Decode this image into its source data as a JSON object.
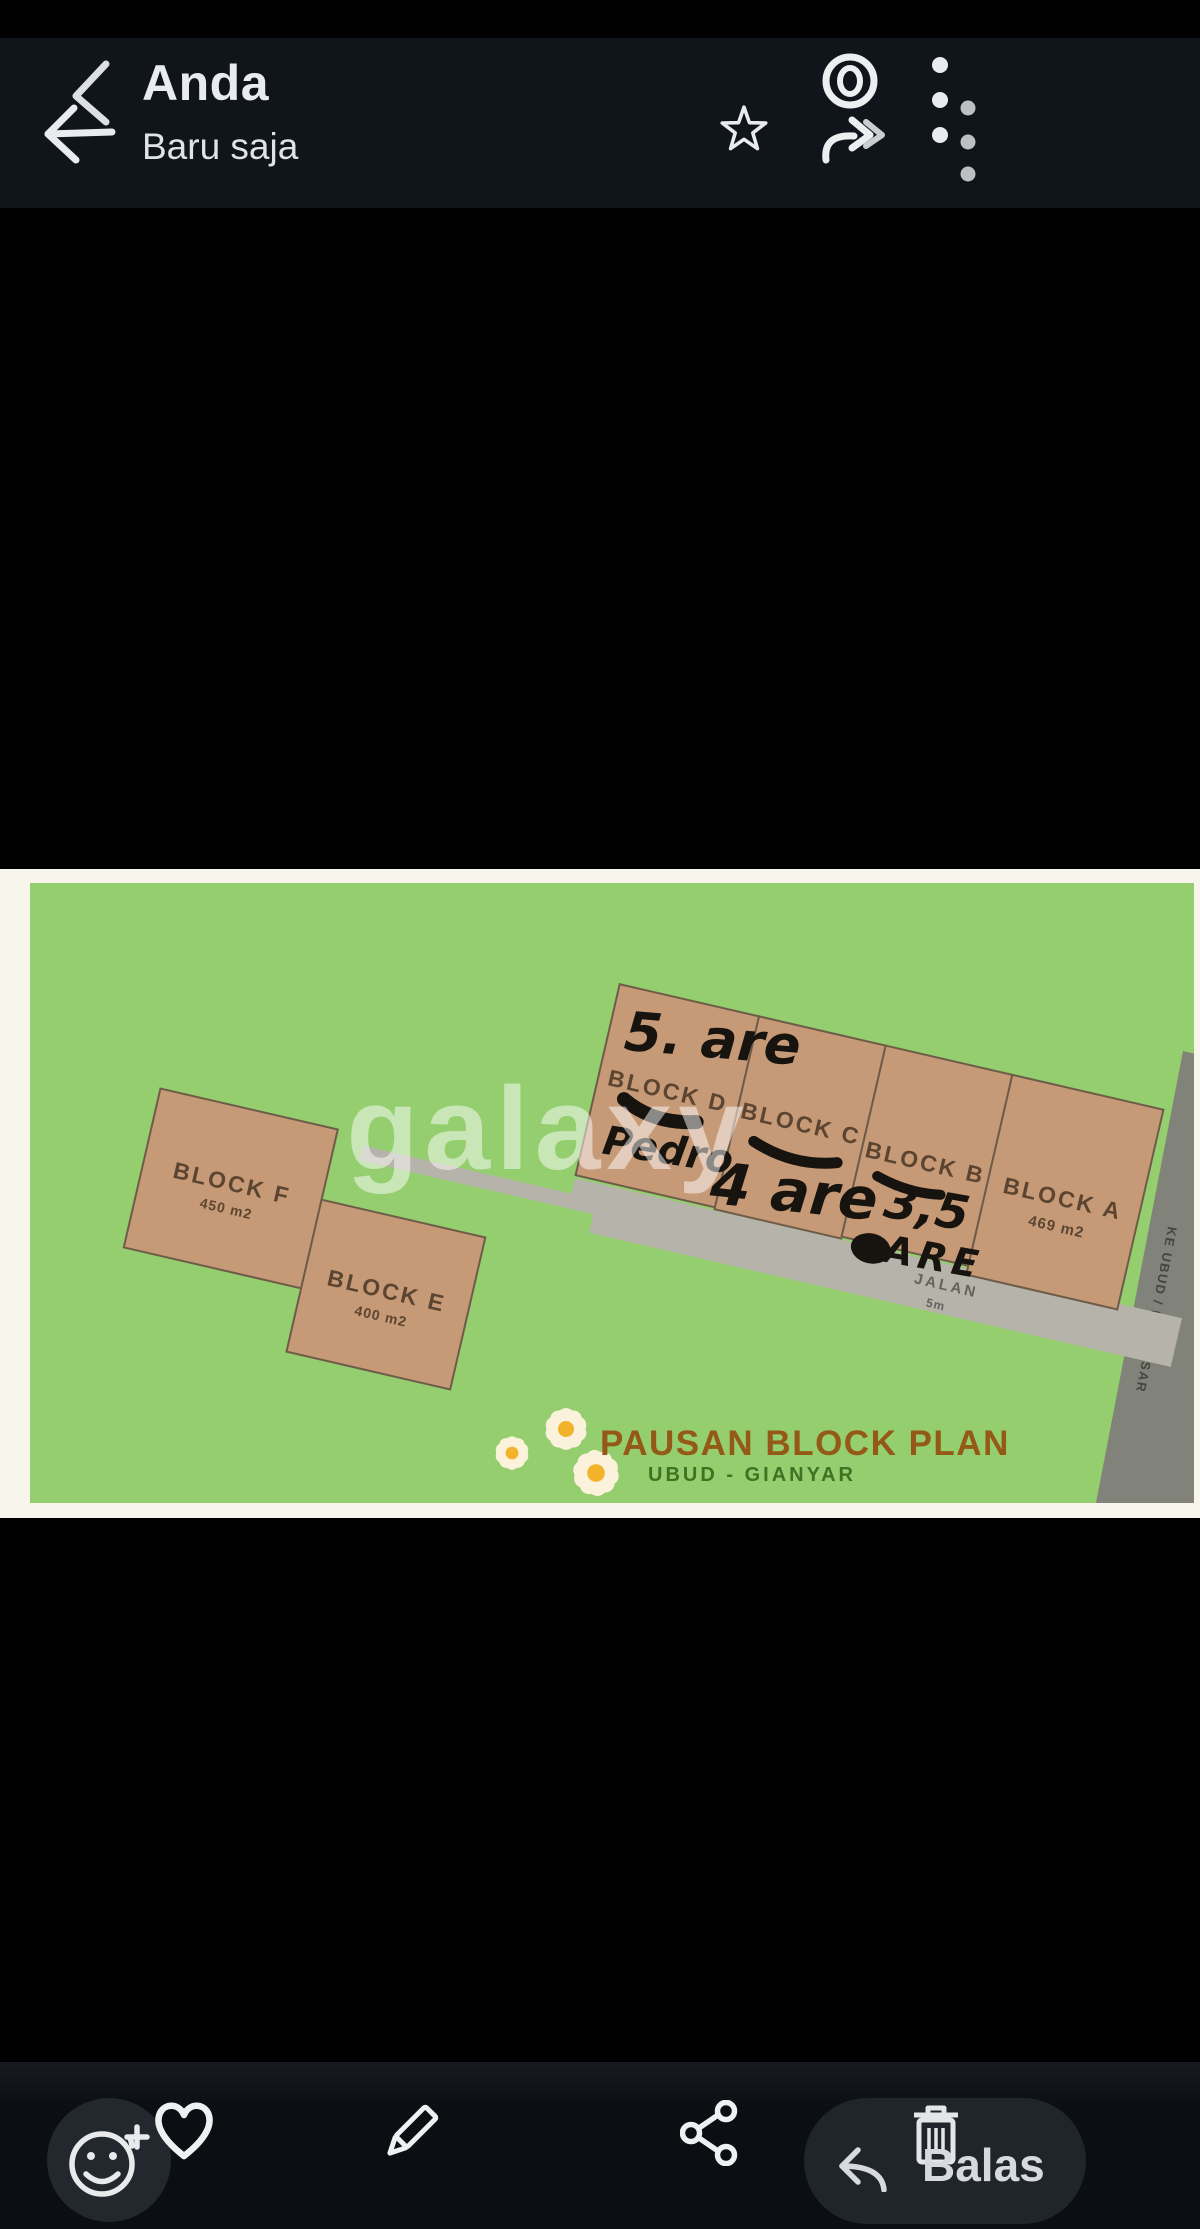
{
  "app_bar": {
    "title": "Anda",
    "subtitle": "Baru saja",
    "icons": [
      "back-arrow",
      "star",
      "view-once-eye",
      "forward-arrow",
      "overflow-menu"
    ]
  },
  "plan": {
    "watermark": "galaxy",
    "blocks": [
      {
        "name": "BLOCK F",
        "area": "450 m2"
      },
      {
        "name": "BLOCK E",
        "area": "400 m2"
      },
      {
        "name": "BLOCK D",
        "area": ""
      },
      {
        "name": "BLOCK C",
        "area": ""
      },
      {
        "name": "BLOCK B",
        "area": ""
      },
      {
        "name": "BLOCK A",
        "area": "469 m2"
      }
    ],
    "annotations": {
      "above_block_d": "5. are",
      "on_block_d": "Pedro",
      "on_block_c": "4 are",
      "on_block_b_value": "3,5",
      "on_block_b_unit": "ARE"
    },
    "road": {
      "label": "JALAN",
      "width": "5m"
    },
    "side_road": "KE UBUD / DENPASAR",
    "logo": {
      "title": "PAUSAN BLOCK PLAN",
      "subtitle": "UBUD - GIANYAR"
    }
  },
  "bottom_bar": {
    "icons": [
      "add-reaction",
      "heart",
      "pencil",
      "share",
      "reply",
      "trash"
    ],
    "reply_label": "Balas"
  },
  "colors": {
    "field_green": "#94ce6e",
    "parcel_tan": "#c79a77",
    "road_light": "#b5b3aa",
    "road_dark": "#81827a",
    "paper_cream": "#f8f5ec",
    "label_brown": "#5c4530",
    "logo_brown": "#945817",
    "logo_green": "#3f7222",
    "ink": "#17130e",
    "appbar_bg": "#10141b"
  }
}
